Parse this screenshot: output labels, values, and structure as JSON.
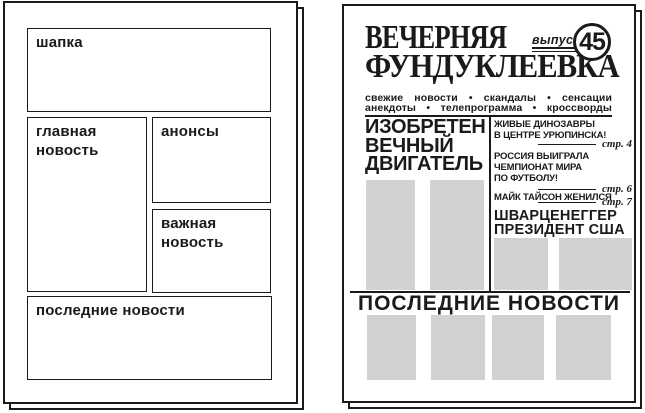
{
  "layout_template": {
    "header_label": "шапка",
    "main_news_label": "главная\nновость",
    "announcements_label": "анонсы",
    "important_news_label": "важная\nновость",
    "latest_news_label": "последние новости"
  },
  "newspaper": {
    "masthead_line1": "ВЕЧЕРНЯЯ",
    "masthead_line2": "ФУНДУКЛЕЕВКА",
    "issue_label": "выпуск",
    "issue_number": "45",
    "tagline_row1": "свежие новости • скандалы • сенсации",
    "tagline_row2": "анекдоты • телепрограмма • кроссворды",
    "main_headline": "ИЗОБРЕТЕН\nВЕЧНЫЙ\nДВИГАТЕЛЬ",
    "briefs": [
      {
        "text": "ЖИВЫЕ ДИНОЗАВРЫ\nВ ЦЕНТРЕ УРЮПИНСКА!",
        "page_ref": "стр. 4"
      },
      {
        "text": "РОССИЯ ВЫИГРАЛА\nЧЕМПИОНАТ МИРА\nПО ФУТБОЛУ!",
        "page_ref": "стр. 6"
      },
      {
        "text": "МАЙК ТАЙСОН ЖЕНИЛСЯ",
        "page_ref": "стр. 7"
      }
    ],
    "secondary_headline": "ШВАРЦЕНЕГГЕР\nПРЕЗИДЕНТ США",
    "section_headline": "ПОСЛЕДНИЕ НОВОСТИ"
  },
  "colors": {
    "ink": "#1a1a1a",
    "paper": "#ffffff",
    "placeholder": "#d2d2d2"
  }
}
